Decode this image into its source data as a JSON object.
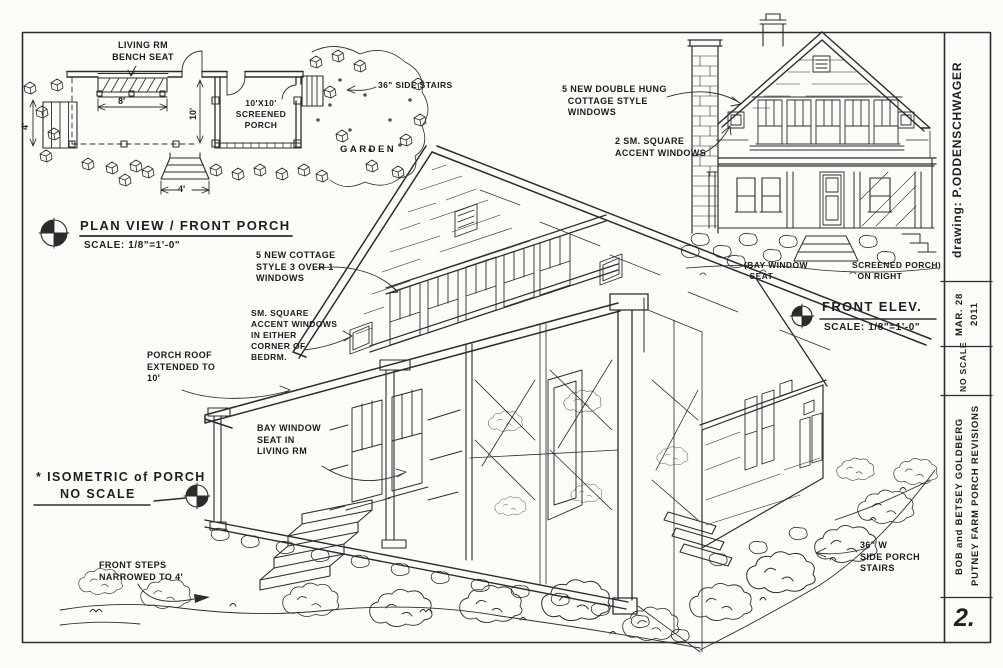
{
  "sheet": {
    "ink_color": "#2c2c2c",
    "paper_color": "#fcfbf7",
    "number": "2."
  },
  "title_block": {
    "drawing_by": "drawing: P.ODDENSCHWAGER",
    "date": "MAR. 28\n2011",
    "scale_note": "NO SCALE",
    "project": "BOB and BETSEY GOLDBERG\nPUTNEY FARM PORCH REVISIONS",
    "sheet_number": "2."
  },
  "plan_view": {
    "title": "PLAN VIEW / FRONT PORCH",
    "scale": "SCALE: 1/8\"=1'-0\"",
    "labels": {
      "bench": "LIVING RM\nBENCH SEAT",
      "side_stairs": "36\" SIDE STAIRS",
      "screened_porch": "10'X10'\nSCREENED\nPORCH",
      "garden": "GARDEN"
    },
    "dimensions": {
      "bench_width": "8'",
      "left_stairs": "4'",
      "porch_depth": "10'",
      "front_steps": "4'"
    }
  },
  "isometric": {
    "title": "* ISOMETRIC of PORCH",
    "scale_note": "NO SCALE",
    "labels": {
      "cottage_windows": "5 NEW COTTAGE\nSTYLE 3 OVER 1\nWINDOWS",
      "accent_windows": "SM. SQUARE\nACCENT WINDOWS\nIN EITHER\nCORNER OF\nBEDRM.",
      "porch_roof": "PORCH ROOF\nEXTENDED TO\n10'",
      "bay_window": "BAY WINDOW\nSEAT IN\nLIVING RM",
      "front_steps": "FRONT STEPS\nNARROWED TO 4'",
      "side_stairs": "36\" W\nSIDE PORCH\nSTAIRS"
    }
  },
  "elevation": {
    "title": "FRONT ELEV.",
    "scale": "SCALE: 1/8\"=1'-0\"",
    "labels": {
      "double_hung": "5 NEW DOUBLE HUNG\n  COTTAGE STYLE\n  WINDOWS",
      "accent": "2 SM. SQUARE\nACCENT WINDOWS",
      "bay_seat": "(BAY WINDOW\n  SEAT",
      "screened_porch": "SCREENED PORCH)\n  ON RIGHT"
    }
  }
}
